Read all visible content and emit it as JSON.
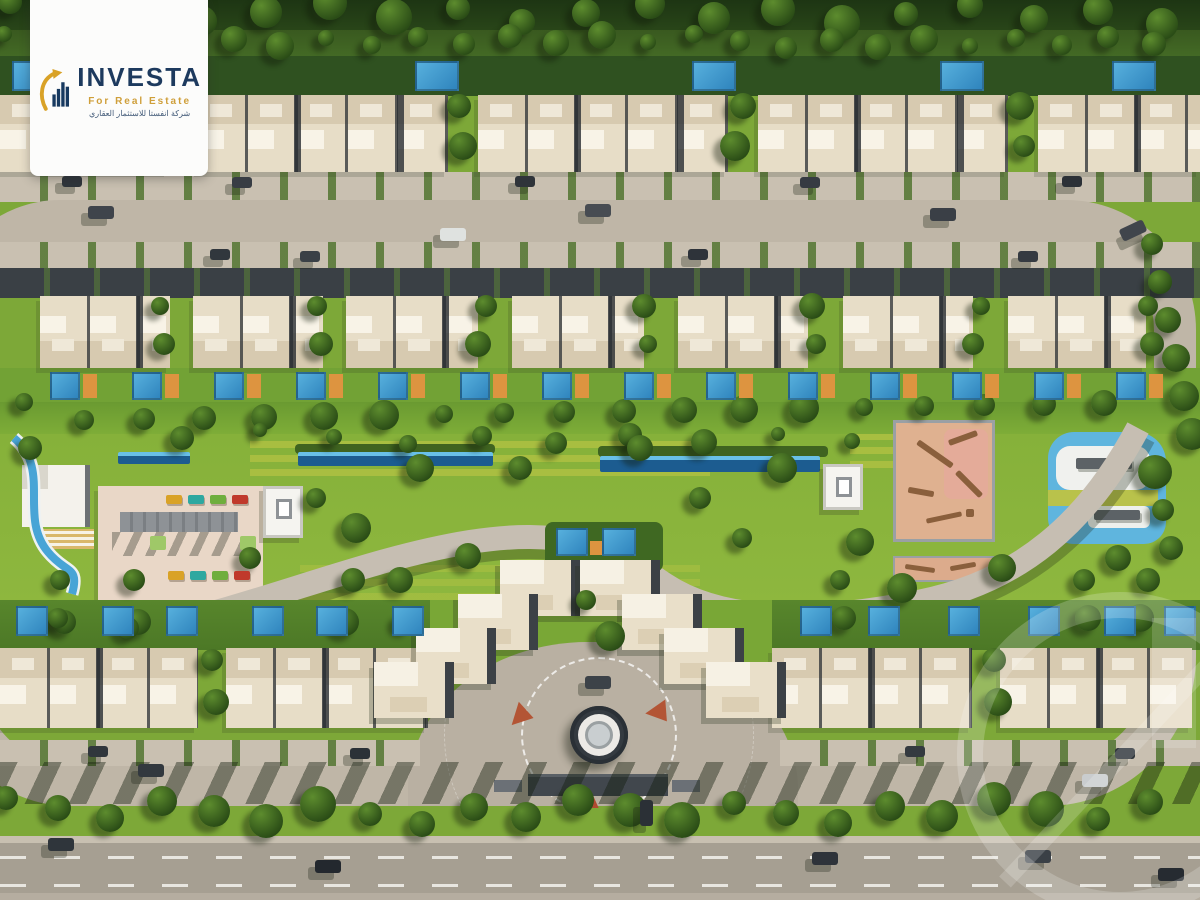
{
  "logo": {
    "brand": "INVESTA",
    "tagline": "For Real Estate",
    "tagline_ar": "شركة انفستا للاستثمار العقاري"
  },
  "palette": {
    "navy": "#1d3a5e",
    "gold": "#d9a227",
    "lawn": "#8db33c",
    "road": "#bfb6a7",
    "boulevard": "#a69f92",
    "roof": "#e7ddc7",
    "pool_blue": "#3f97cf",
    "deck_orange": "#dd9440",
    "play_pink": "#dfb190"
  },
  "scene": {
    "top_pools": [
      {
        "x": 12
      },
      {
        "x": 415
      },
      {
        "x": 692
      },
      {
        "x": 940
      },
      {
        "x": 1112
      }
    ],
    "house_rows": [
      {
        "id": "row1",
        "y": 95,
        "h": 77,
        "front": "bottom",
        "blocks": [
          {
            "x": 0,
            "w": 168
          },
          {
            "x": 198,
            "w": 250
          },
          {
            "x": 478,
            "w": 250
          },
          {
            "x": 758,
            "w": 250
          },
          {
            "x": 1038,
            "w": 162
          }
        ]
      },
      {
        "id": "row2",
        "y": 296,
        "h": 72,
        "front": "top",
        "blocks": [
          {
            "x": 40,
            "w": 130
          },
          {
            "x": 193,
            "w": 130
          },
          {
            "x": 346,
            "w": 132
          },
          {
            "x": 512,
            "w": 132
          },
          {
            "x": 678,
            "w": 130
          },
          {
            "x": 843,
            "w": 130
          },
          {
            "x": 1008,
            "w": 138
          }
        ]
      },
      {
        "id": "row3L",
        "y": 648,
        "h": 80,
        "front": "bottom",
        "blocks": [
          {
            "x": 0,
            "w": 198
          },
          {
            "x": 226,
            "w": 202
          }
        ]
      },
      {
        "id": "row3R",
        "y": 648,
        "h": 80,
        "front": "bottom",
        "blocks": [
          {
            "x": 772,
            "w": 200
          },
          {
            "x": 1000,
            "w": 192
          }
        ]
      }
    ],
    "row2_pools": {
      "x0": 50,
      "x1": 1145,
      "step": 82,
      "y": 372
    },
    "row3_pools": {
      "left": [
        16,
        102,
        166,
        252,
        316,
        392
      ],
      "right": [
        800,
        868,
        948,
        1028,
        1104,
        1164
      ],
      "y": 606
    },
    "cluster_houses": [
      {
        "x": 540,
        "y": 560
      },
      {
        "x": 498,
        "y": 594
      },
      {
        "x": 456,
        "y": 628
      },
      {
        "x": 414,
        "y": 662
      },
      {
        "x": 620,
        "y": 560
      },
      {
        "x": 662,
        "y": 594
      },
      {
        "x": 704,
        "y": 628
      },
      {
        "x": 746,
        "y": 662
      }
    ],
    "cluster_pools": [
      {
        "x": 556,
        "y": 528,
        "w": 32,
        "h": 28
      },
      {
        "x": 602,
        "y": 528,
        "w": 34,
        "h": 28
      }
    ],
    "loungers": [
      {
        "x": 166,
        "y": 495,
        "c": "#d9a227"
      },
      {
        "x": 188,
        "y": 495,
        "c": "#2ea8a0"
      },
      {
        "x": 210,
        "y": 495,
        "c": "#6fae3d"
      },
      {
        "x": 232,
        "y": 495,
        "c": "#c0392b"
      },
      {
        "x": 168,
        "y": 571,
        "c": "#d9a227"
      },
      {
        "x": 190,
        "y": 571,
        "c": "#2ea8a0"
      },
      {
        "x": 212,
        "y": 571,
        "c": "#6fae3d"
      },
      {
        "x": 234,
        "y": 571,
        "c": "#c0392b"
      }
    ],
    "cars": [
      {
        "x": 88,
        "y": 206,
        "c": "#3f444b"
      },
      {
        "x": 440,
        "y": 228,
        "c": "#dfe2e0"
      },
      {
        "x": 585,
        "y": 204,
        "c": "#474c52"
      },
      {
        "x": 930,
        "y": 208,
        "c": "#3a3f46"
      },
      {
        "x": 1120,
        "y": 224,
        "c": "#40454c",
        "rot": -25
      },
      {
        "x": 62,
        "y": 176,
        "c": "#2f353b",
        "w": 20,
        "h": 11
      },
      {
        "x": 232,
        "y": 177,
        "c": "#383d44",
        "w": 20,
        "h": 11
      },
      {
        "x": 515,
        "y": 176,
        "c": "#2f343a",
        "w": 20,
        "h": 11
      },
      {
        "x": 800,
        "y": 177,
        "c": "#363b42",
        "w": 20,
        "h": 11
      },
      {
        "x": 1062,
        "y": 176,
        "c": "#2c3137",
        "w": 20,
        "h": 11
      },
      {
        "x": 210,
        "y": 249,
        "c": "#31373d",
        "w": 20,
        "h": 11
      },
      {
        "x": 300,
        "y": 251,
        "c": "#3a4046",
        "w": 20,
        "h": 11
      },
      {
        "x": 688,
        "y": 249,
        "c": "#2e333a",
        "w": 20,
        "h": 11
      },
      {
        "x": 1018,
        "y": 251,
        "c": "#353a41",
        "w": 20,
        "h": 11
      },
      {
        "x": 585,
        "y": 676,
        "c": "#3c4248"
      },
      {
        "x": 138,
        "y": 764,
        "c": "#32383e"
      },
      {
        "x": 1082,
        "y": 774,
        "c": "#c9ccce"
      },
      {
        "x": 88,
        "y": 746,
        "c": "#30363c",
        "w": 20,
        "h": 11
      },
      {
        "x": 350,
        "y": 748,
        "c": "#2b3137",
        "w": 20,
        "h": 11
      },
      {
        "x": 905,
        "y": 746,
        "c": "#343a40",
        "w": 20,
        "h": 11
      },
      {
        "x": 1115,
        "y": 748,
        "c": "#2e343a",
        "w": 20,
        "h": 11
      },
      {
        "x": 640,
        "y": 800,
        "c": "#2b3036",
        "w": 13,
        "h": 26
      },
      {
        "x": 48,
        "y": 838,
        "c": "#2f353b"
      },
      {
        "x": 315,
        "y": 860,
        "c": "#23282e"
      },
      {
        "x": 812,
        "y": 852,
        "c": "#2e333a"
      },
      {
        "x": 1025,
        "y": 850,
        "c": "#3a4046"
      },
      {
        "x": 1158,
        "y": 868,
        "c": "#262b31"
      }
    ],
    "tree_rows": [
      {
        "y0": 2,
        "y1": 24,
        "x0": 10,
        "x1": 1190,
        "step": 64,
        "r": 15
      },
      {
        "y0": 34,
        "y1": 48,
        "x0": 4,
        "x1": 1196,
        "step": 46,
        "r": 11
      },
      {
        "y0": 402,
        "y1": 420,
        "x0": 24,
        "x1": 1150,
        "step": 60,
        "r": 12
      },
      {
        "y0": 798,
        "y1": 824,
        "x0": 6,
        "x1": 1194,
        "step": 52,
        "r": 15
      },
      {
        "vert": true,
        "x0": 1152,
        "x1": 1196,
        "y0": 244,
        "y1": 566,
        "step": 38,
        "r": 14
      },
      {
        "y0": 430,
        "y1": 444,
        "x0": 260,
        "x1": 900,
        "step": 74,
        "r": 10
      }
    ],
    "gap_trees": [
      {
        "xs": [
          170,
          455,
          735,
          1020
        ],
        "ys": [
          106,
          146
        ],
        "r": 13
      },
      {
        "xs": [
          160,
          313,
          478,
          644,
          808,
          973,
          1148
        ],
        "ys": [
          306,
          344
        ],
        "r": 11
      },
      {
        "xs": [
          212,
          990
        ],
        "ys": [
          660,
          702
        ],
        "r": 13
      },
      {
        "xs": [
          60,
          130,
          345,
          400
        ],
        "ys": [
          580,
          622
        ],
        "r": 12
      },
      {
        "xs": [
          840,
          1080,
          1140
        ],
        "ys": [
          580,
          618
        ],
        "r": 12
      }
    ],
    "amenity_trees": [
      {
        "x": 316,
        "y": 498
      },
      {
        "x": 356,
        "y": 528
      },
      {
        "x": 420,
        "y": 468
      },
      {
        "x": 468,
        "y": 556
      },
      {
        "x": 520,
        "y": 468
      },
      {
        "x": 700,
        "y": 498
      },
      {
        "x": 742,
        "y": 538
      },
      {
        "x": 782,
        "y": 468
      },
      {
        "x": 860,
        "y": 542
      },
      {
        "x": 640,
        "y": 448
      },
      {
        "x": 182,
        "y": 438
      },
      {
        "x": 250,
        "y": 558
      },
      {
        "x": 58,
        "y": 618
      },
      {
        "x": 902,
        "y": 588
      },
      {
        "x": 1002,
        "y": 568
      },
      {
        "x": 1118,
        "y": 558
      },
      {
        "x": 30,
        "y": 448
      },
      {
        "x": 128,
        "y": 628
      },
      {
        "x": 586,
        "y": 600
      },
      {
        "x": 610,
        "y": 636
      }
    ]
  }
}
